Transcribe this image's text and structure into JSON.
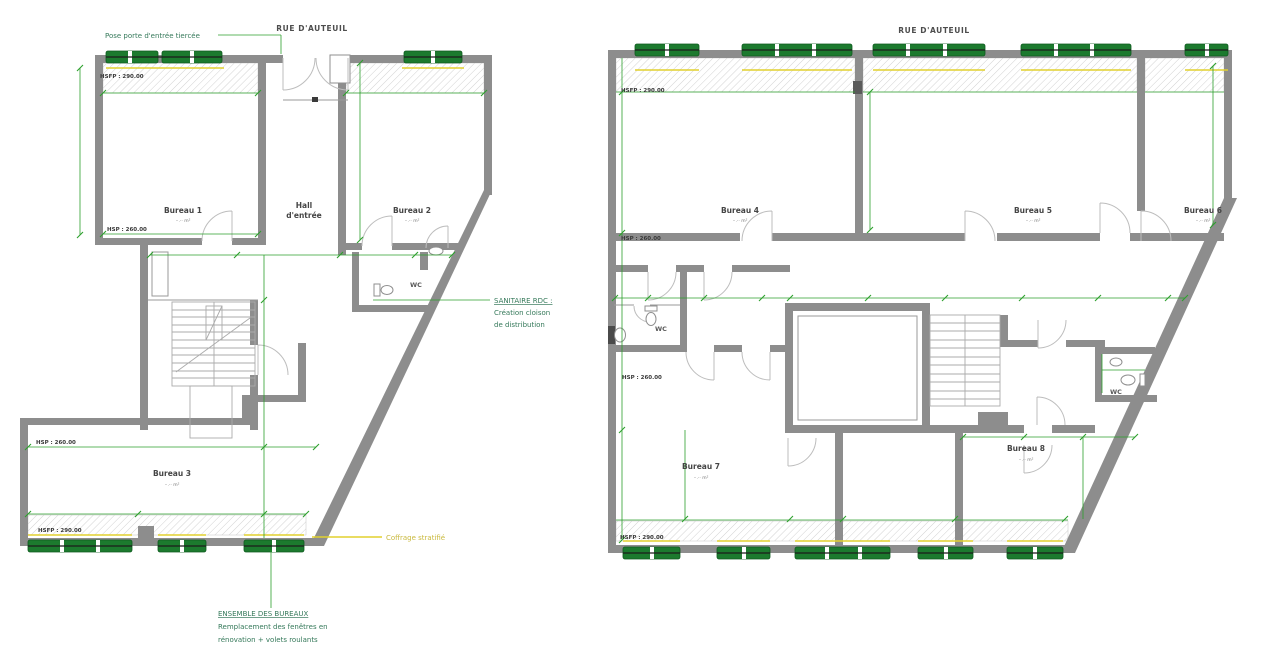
{
  "street_label_left": "RUE D'AUTEUIL",
  "street_label_right": "RUE D'AUTEUIL",
  "height_labels": {
    "hsfp": "HSFP : 290.00",
    "hsp": "HSP : 260.00"
  },
  "left_plan": {
    "rooms": {
      "bureau1": {
        "label": "Bureau 1",
        "area": "··.·· m²"
      },
      "bureau2": {
        "label": "Bureau 2",
        "area": "··.·· m²"
      },
      "bureau3": {
        "label": "Bureau 3",
        "area": "··.·· m²"
      },
      "hall": {
        "line1": "Hall",
        "line2": "d'entrée"
      },
      "wc": {
        "label": "WC"
      }
    },
    "annotations": {
      "entry_door": "Pose porte d'entrée tiercée",
      "sanitaire_line1": "SANITAIRE RDC :",
      "sanitaire_line2": "Création cloison",
      "sanitaire_line3": "de distribution",
      "coffrage": "Coffrage stratifié",
      "ensemble_line1": "ENSEMBLE DES BUREAUX",
      "ensemble_line2": "Remplacement des fenêtres en",
      "ensemble_line3": "rénovation + volets roulants"
    }
  },
  "right_plan": {
    "rooms": {
      "bureau4": {
        "label": "Bureau 4",
        "area": "··.·· m²"
      },
      "bureau5": {
        "label": "Bureau 5",
        "area": "··.·· m²"
      },
      "bureau6": {
        "label": "Bureau 6",
        "area": "··.·· m²"
      },
      "bureau7": {
        "label": "Bureau 7",
        "area": "··.·· m²"
      },
      "bureau8": {
        "label": "Bureau 8",
        "area": "··.·· m²"
      },
      "wc_left": {
        "label": "WC"
      },
      "wc_right": {
        "label": "WC"
      }
    }
  },
  "colors": {
    "wall_gray": "#8d8d8d",
    "dimension_green": "#2da02d",
    "shutter_green": "#1c7a2e",
    "coffrage_yellow": "#e2d12e",
    "annotation_green": "#35795a"
  }
}
